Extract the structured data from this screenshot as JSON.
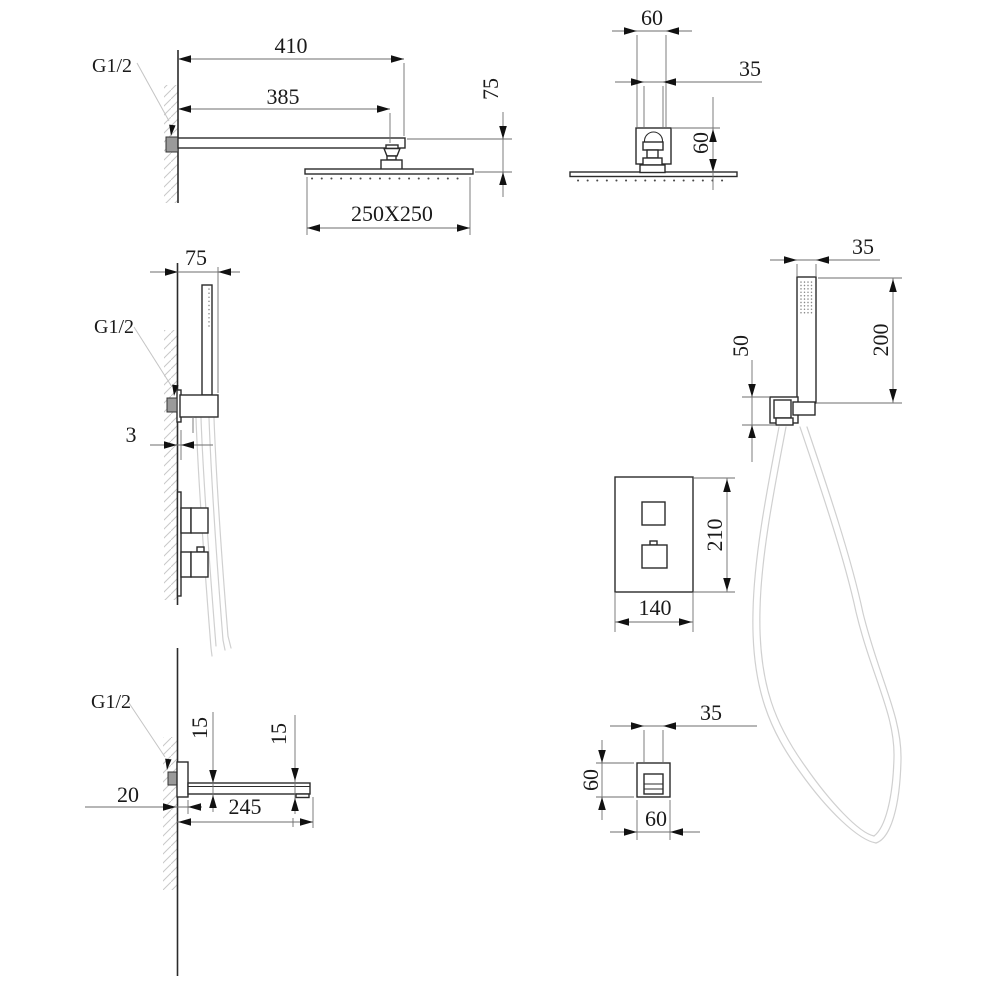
{
  "colors": {
    "line": "#2b2b2b",
    "dim_line": "#6e6e6e",
    "text": "#1a1a1a",
    "leader": "#c4c4c4",
    "hose": "#d0d0d0",
    "connector_fill": "#9a9a9a",
    "background": "#ffffff"
  },
  "drawings": {
    "rainhead_side_view": {
      "thread": "G1/2",
      "dim_arm_overall": "410",
      "dim_arm_to_joint": "385",
      "dim_head_drop": "75",
      "dim_head_size": "250X250"
    },
    "rainhead_front_view": {
      "dim_bracket_width": "60",
      "dim_joint_width": "35",
      "dim_bracket_height": "60"
    },
    "handshower_side_view": {
      "thread": "G1/2",
      "dim_wall_offset": "75",
      "dim_plate_gap": "3"
    },
    "handshower_front_view": {
      "dim_wand_width": "35",
      "dim_wand_length": "200",
      "dim_holder_height": "50"
    },
    "mixer_front_view": {
      "dim_plate_height": "210",
      "dim_plate_width": "140"
    },
    "spout_side_view": {
      "thread": "G1/2",
      "dim_root_height": "15",
      "dim_tip_height": "15",
      "dim_wall_plate_depth": "20",
      "dim_length": "245"
    },
    "spout_front_view": {
      "dim_inner_width": "35",
      "dim_height": "60",
      "dim_width": "60"
    }
  }
}
